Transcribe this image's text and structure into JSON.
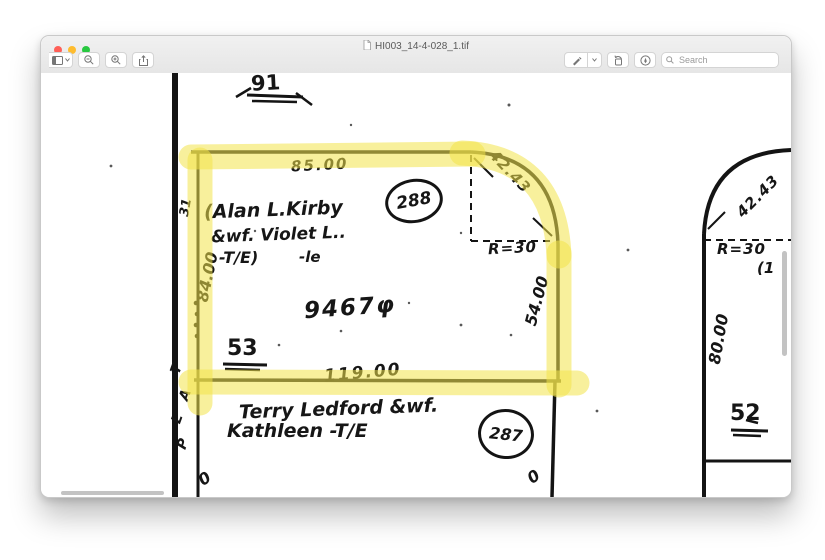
{
  "window": {
    "title": "HI003_14-4-028_1.tif",
    "search_placeholder": "Search"
  },
  "map": {
    "block_number": "91",
    "margin_number": "31",
    "road_letters": [
      "T",
      "A",
      "L",
      "P"
    ],
    "zero_left": "0",
    "zero_right": "0",
    "parcel288": {
      "owner_line1": "(Alan L.Kirby",
      "owner_line2": "&wf. Violet L..",
      "owner_line3": "-T/E)",
      "owner_note": "-le",
      "circle_number": "288",
      "lot_number": "53",
      "area": "9467φ",
      "dim_top": "85.00",
      "dim_left": "84.00",
      "dim_right": "54.00",
      "dim_bottom": "119.00",
      "corner_chord": "42.43",
      "corner_radius": "R=30"
    },
    "parcel287": {
      "owner_line1": "Terry Ledford &wf.",
      "owner_line2": "Kathleen -T/E",
      "circle_number": "287"
    },
    "parcel52": {
      "lot_number": "52",
      "dim_left": "80.00",
      "corner_chord": "42.43",
      "corner_radius": "R=30",
      "paren_note": "(1"
    }
  }
}
